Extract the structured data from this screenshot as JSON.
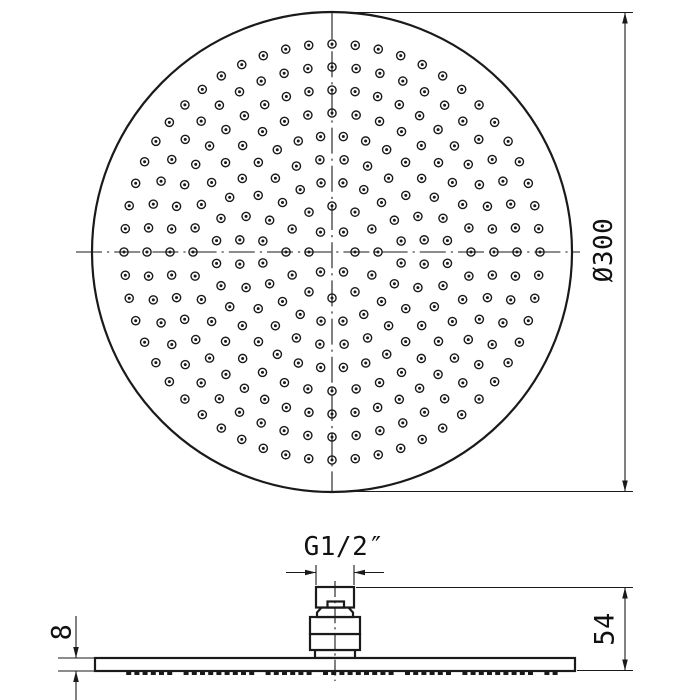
{
  "document": {
    "type": "technical-drawing",
    "subject": "Round rain shower head - top view with nozzle pattern and side profile view"
  },
  "colors": {
    "line": "#1a1a1a",
    "background": "#ffffff"
  },
  "labels": {
    "diameter": "Ø300",
    "thread_size": "G1/2″",
    "connector_height": "54",
    "plate_thickness": "8"
  },
  "dimensions_mm": {
    "head_diameter": 300,
    "overall_height": 54,
    "plate_thickness": 8,
    "thread": "G1/2"
  },
  "top_view": {
    "cx": 332,
    "cy": 252,
    "radius": 240,
    "outline_stroke": 2.2,
    "centerline": {
      "h_x1": 76,
      "h_x2": 580,
      "v_y1": 13,
      "v_y2": 491,
      "dash": "26 5 2.2 5"
    },
    "nozzle_rings": {
      "radii": [
        23,
        46,
        70,
        93,
        116,
        139,
        162,
        185,
        208
      ],
      "counts": [
        6,
        12,
        20,
        24,
        32,
        36,
        44,
        48,
        56
      ],
      "offsets_deg": [
        0,
        0,
        9,
        7.5,
        5.6,
        0,
        0,
        0,
        0
      ],
      "hole_outer_r": 4.1,
      "hole_inner_r": 1.5,
      "hole_stroke": 1.4
    },
    "dim": {
      "ext_y_top": 12.5,
      "ext_y_bottom": 491.5,
      "ext_x1": 337,
      "ext_x2": 633,
      "line_x": 625
    }
  },
  "side_view": {
    "center_x": 335,
    "plate": {
      "x": 95,
      "y": 658,
      "w": 480,
      "h": 13
    },
    "teeth": {
      "x_start": 118,
      "x_end": 556,
      "pitch": 8.2,
      "w": 5,
      "h": 4,
      "y": 671
    },
    "neck": {
      "x": 315,
      "y": 650,
      "w": 40,
      "h": 8
    },
    "body_lower": {
      "x": 310,
      "y": 634,
      "w": 50,
      "h": 16
    },
    "body_upper": {
      "x": 310,
      "y": 617,
      "w": 50,
      "h": 17
    },
    "flange_points": "317,617 317,612.5 321.5,607.5 348.5,607.5 353,612.5 353,617",
    "thread": {
      "x": 316,
      "y": 587,
      "w": 38,
      "h": 20.5
    },
    "notch": {
      "x": 327.5,
      "y": 601.5,
      "w": 16.5,
      "h": 6
    },
    "centerline": {
      "y1": 581,
      "y2": 681,
      "dash": "16 4 2.2 4"
    },
    "dim_thread": {
      "ext_left_x": 316,
      "ext_right_x": 354,
      "ext_y1": 565,
      "ext_y2": 585,
      "arrow_y": 572.5,
      "tail": 30
    },
    "dim_height": {
      "ext_top": {
        "x1": 356,
        "x2": 633,
        "y": 587.5
      },
      "ext_bottom": {
        "x1": 577,
        "x2": 633,
        "y": 670.5
      },
      "line_x": 625
    },
    "dim_thickness": {
      "ext_x1": 58,
      "ext_x2": 94,
      "top_y": 658,
      "bottom_y": 671,
      "line_x": 76,
      "tail_top_y": 616,
      "tail_bottom_y": 700
    }
  }
}
